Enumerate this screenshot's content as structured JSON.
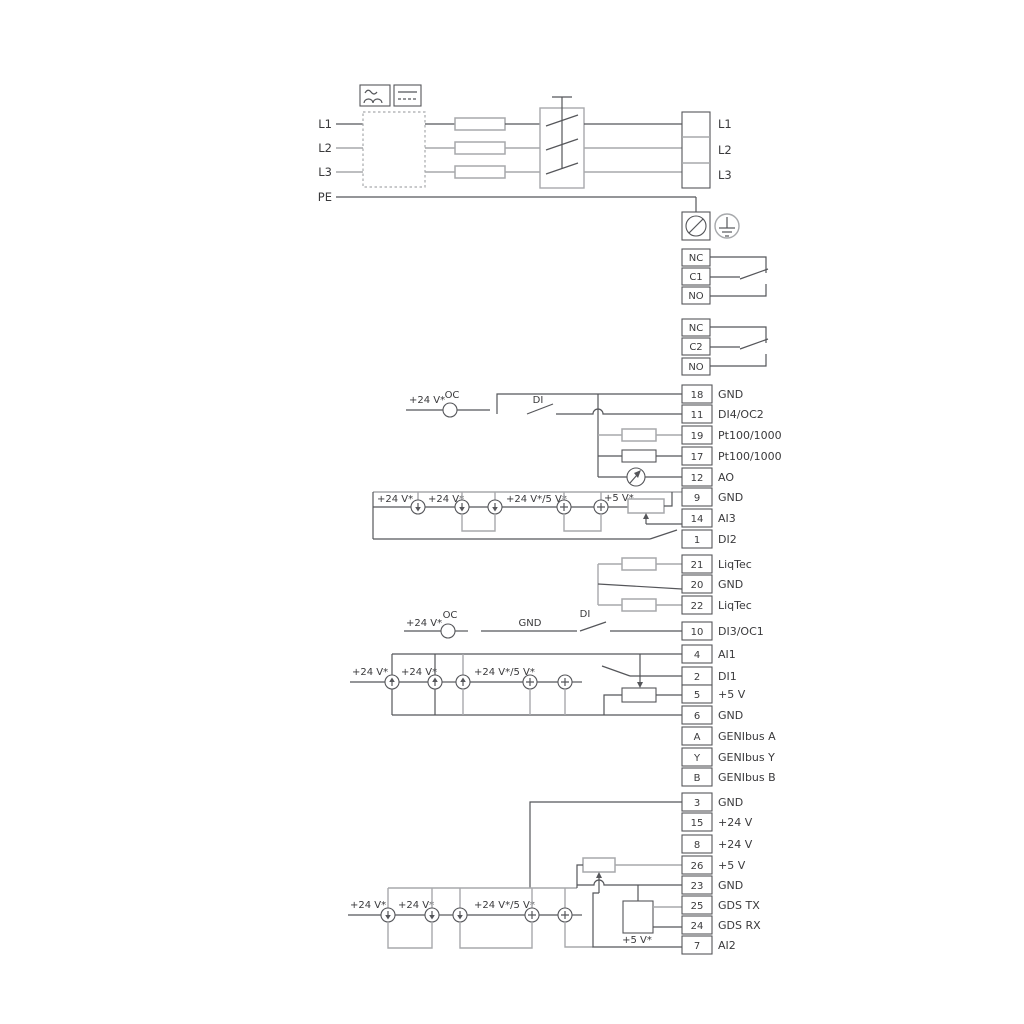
{
  "colors": {
    "dark": "#55565a",
    "gray": "#a7a9ac",
    "text": "#3a3a3c",
    "bg": "#ffffff"
  },
  "power": {
    "inputs": [
      "L1",
      "L2",
      "L3",
      "PE"
    ],
    "outputs": [
      "L1",
      "L2",
      "L3"
    ]
  },
  "relays": [
    {
      "terminals": [
        "NC",
        "C1",
        "NO"
      ]
    },
    {
      "terminals": [
        "NC",
        "C2",
        "NO"
      ]
    }
  ],
  "groups": {
    "a": [
      {
        "num": "18",
        "label": "GND"
      },
      {
        "num": "11",
        "label": "DI4/OC2"
      },
      {
        "num": "19",
        "label": "Pt100/1000"
      },
      {
        "num": "17",
        "label": "Pt100/1000"
      },
      {
        "num": "12",
        "label": "AO"
      },
      {
        "num": "9",
        "label": "GND"
      },
      {
        "num": "14",
        "label": "AI3"
      },
      {
        "num": "1",
        "label": "DI2"
      }
    ],
    "b": [
      {
        "num": "21",
        "label": "LiqTec"
      },
      {
        "num": "20",
        "label": "GND"
      },
      {
        "num": "22",
        "label": "LiqTec"
      }
    ],
    "c": [
      {
        "num": "10",
        "label": "DI3/OC1"
      }
    ],
    "d": [
      {
        "num": "4",
        "label": "AI1"
      },
      {
        "num": "2",
        "label": "DI1"
      },
      {
        "num": "5",
        "label": "+5 V"
      },
      {
        "num": "6",
        "label": "GND"
      }
    ],
    "e": [
      {
        "num": "A",
        "label": "GENIbus A"
      },
      {
        "num": "Y",
        "label": "GENIbus Y"
      },
      {
        "num": "B",
        "label": "GENIbus B"
      }
    ],
    "f": [
      {
        "num": "3",
        "label": "GND"
      },
      {
        "num": "15",
        "label": "+24 V"
      },
      {
        "num": "8",
        "label": "+24 V"
      },
      {
        "num": "26",
        "label": "+5 V"
      },
      {
        "num": "23",
        "label": "GND"
      },
      {
        "num": "25",
        "label": "GDS TX"
      },
      {
        "num": "24",
        "label": "GDS RX"
      },
      {
        "num": "7",
        "label": "AI2"
      }
    ]
  },
  "di4_row": {
    "v24": "+24 V*",
    "oc": "OC",
    "di": "DI"
  },
  "ai3_row": {
    "v24a": "+24 V*",
    "v24b": "+24 V*",
    "v24_5": "+24 V*/5 V*",
    "v5": "+5 V*"
  },
  "di3_row": {
    "v24": "+24 V*",
    "oc": "OC",
    "gnd": "GND",
    "di": "DI"
  },
  "ai1_row": {
    "v24a": "+24 V*",
    "v24b": "+24 V*",
    "v24_5": "+24 V*/5 V*"
  },
  "ai2_row": {
    "v24a": "+24 V*",
    "v24b": "+24 V*",
    "v24_5": "+24 V*/5 V*",
    "v5": "+5 V*"
  }
}
